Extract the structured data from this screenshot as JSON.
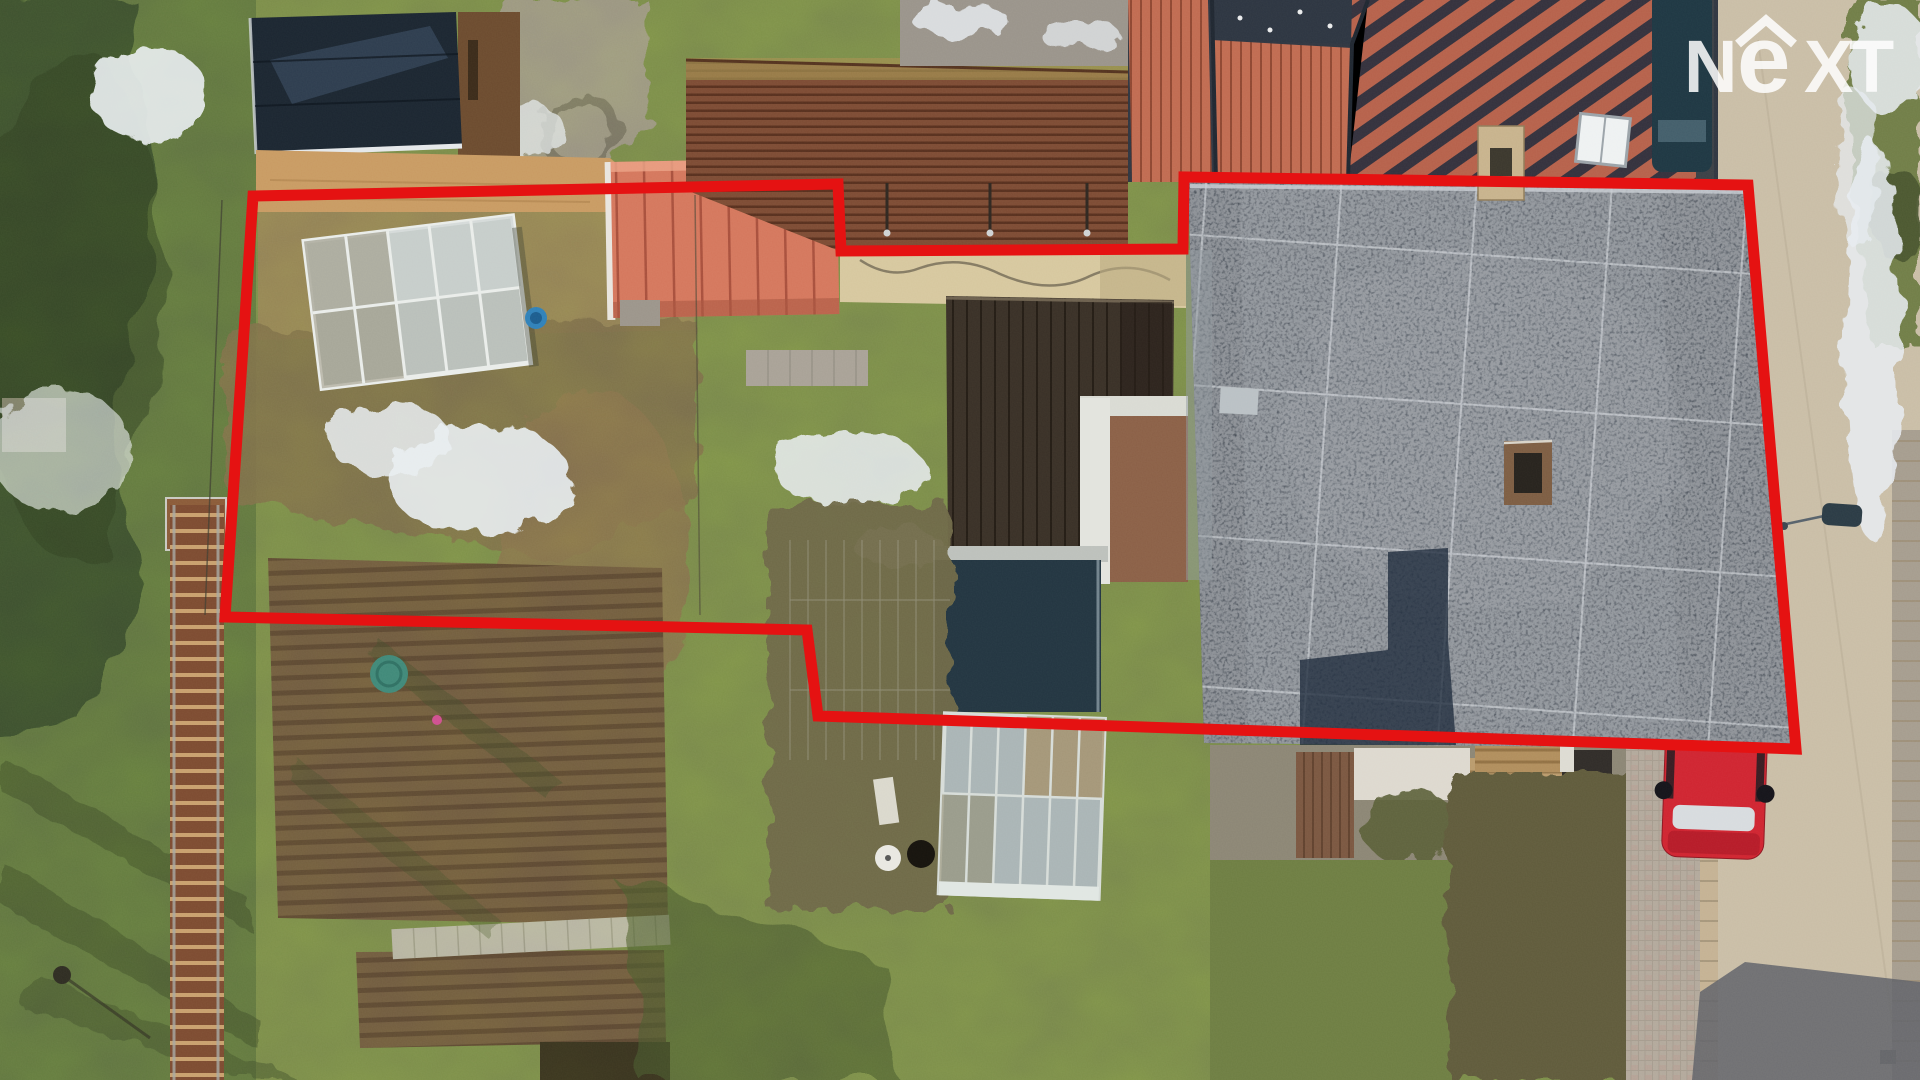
{
  "image": {
    "kind": "aerial-drone-photo",
    "subject": "residential plot with garden, sheds, greenhouses, flat-roof house and street",
    "width": 1920,
    "height": 1080
  },
  "watermark": {
    "brand": "NEXT",
    "letters": {
      "n": "N",
      "e": "e",
      "x": "X",
      "t": "T"
    },
    "icon": "roof-chevron",
    "color": "#ffffff",
    "opacity": 0.85
  },
  "annotation": {
    "label": "property-boundary",
    "color": "#e51212",
    "stroke_width": 11,
    "points": "253,196 838,184 841,251 1183,249 1184,177 1748,185 1796,749 818,716 807,630 225,617"
  },
  "colors": {
    "lawn": "#76854a",
    "lawn_dark": "#5e7140",
    "conifer": "#3a4e2d",
    "scrub": "#8f7c55",
    "bramble": "#7a6a4c",
    "soil": "#6d573f",
    "snow": "#e8edf2",
    "street": "#c9bda6",
    "sidewalk": "#b2a89b",
    "curb": "#c4b193",
    "flat_roof": "#4a515b",
    "roof_seam": "#c3c9cf",
    "roof_shadow": "#1e2a3c",
    "salmon_shed": "#d4765c",
    "brown_shed": "#7c4a33",
    "black_shed": "#1b2530",
    "tiled_roof": "#c06a50",
    "tiled_roof_dark": "#2c3440",
    "deck": "#382f26",
    "greenhouse_glass": "#b9bfba",
    "white_wall": "#e2e3dd",
    "terracotta": "#8a5f46",
    "cream_wall": "#d6c79e",
    "hedge": "#5e5a3a",
    "car_red": "#cf2430",
    "van_dark": "#1e3642",
    "well_lid": "#3f8878",
    "bucket_blue": "#2f80b8",
    "street_shadow": "#5f6268"
  },
  "scene": {
    "elements": [
      "black-roof garden shed (top-left)",
      "glass greenhouse upper garden",
      "salmon red-roof shed",
      "rusty corrugated shed",
      "neighbor tiled roofs (top)",
      "large charcoal flat roof house",
      "wooden terrace deck",
      "second greenhouse (bottom-center)",
      "vegetable soil bed (bottom-left)",
      "wooden walkway",
      "street with paver sidewalk (right)",
      "red parked car",
      "dark van (top-right)",
      "green well lid",
      "snow patches on lawn"
    ]
  }
}
